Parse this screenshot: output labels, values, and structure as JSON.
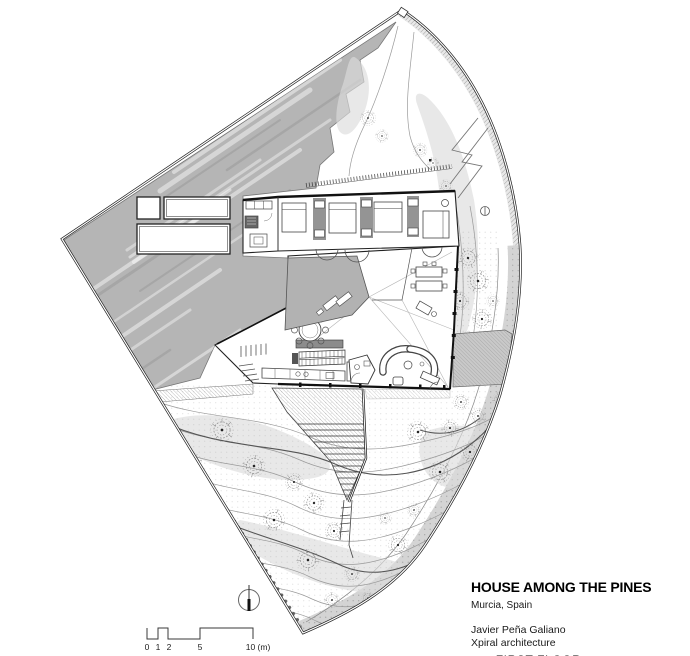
{
  "title_block": {
    "title": "HOUSE AMONG THE PINES",
    "location": "Murcia, Spain",
    "architect": "Javier Peña Galiano",
    "studio": "Xpiral architecture",
    "studio_mark": "xpiral 3",
    "sheet_label": "FIRST FLOOR"
  },
  "scale_bar": {
    "labels": [
      "0",
      "1",
      "2",
      "5",
      "10 (m)"
    ]
  },
  "north_indicator": {
    "icon": "north-arrow-icon"
  },
  "plan": {
    "colors": {
      "slope_gray": "#b5b5b5",
      "courtyard_gray": "#b2b2b2",
      "vegetation_gray": "#dcdcdc",
      "band_gray": "#cdcdcd",
      "line_dark": "#111111",
      "line_mid": "#555555",
      "contour_gray": "#999999"
    }
  }
}
